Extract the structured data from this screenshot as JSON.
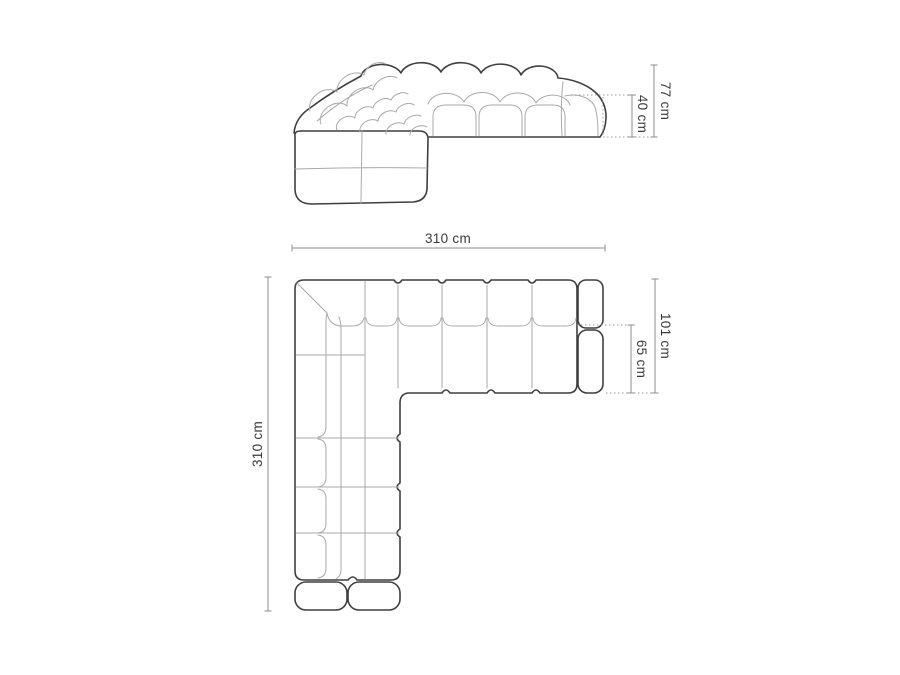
{
  "page": {
    "title": "Corner sofa dimensions diagram",
    "background": "#ffffff"
  },
  "colors": {
    "outline": "#3f3f3f",
    "seam": "#a9a9a9",
    "dimension": "#8d8d8d",
    "dotted": "#9a9a9a",
    "text": "#3a3a3a"
  },
  "views": {
    "elevation": {
      "name": "front perspective view",
      "dimensions": {
        "total_height": {
          "value": 77,
          "unit": "cm",
          "label": "77 cm"
        },
        "seat_height": {
          "value": 40,
          "unit": "cm",
          "label": "40 cm"
        }
      }
    },
    "plan": {
      "name": "top view",
      "dimensions": {
        "total_width": {
          "value": 310,
          "unit": "cm",
          "label": "310 cm"
        },
        "total_length": {
          "value": 310,
          "unit": "cm",
          "label": "310 cm"
        },
        "total_depth": {
          "value": 101,
          "unit": "cm",
          "label": "101 cm"
        },
        "seat_depth": {
          "value": 65,
          "unit": "cm",
          "label": "65 cm"
        }
      }
    }
  }
}
